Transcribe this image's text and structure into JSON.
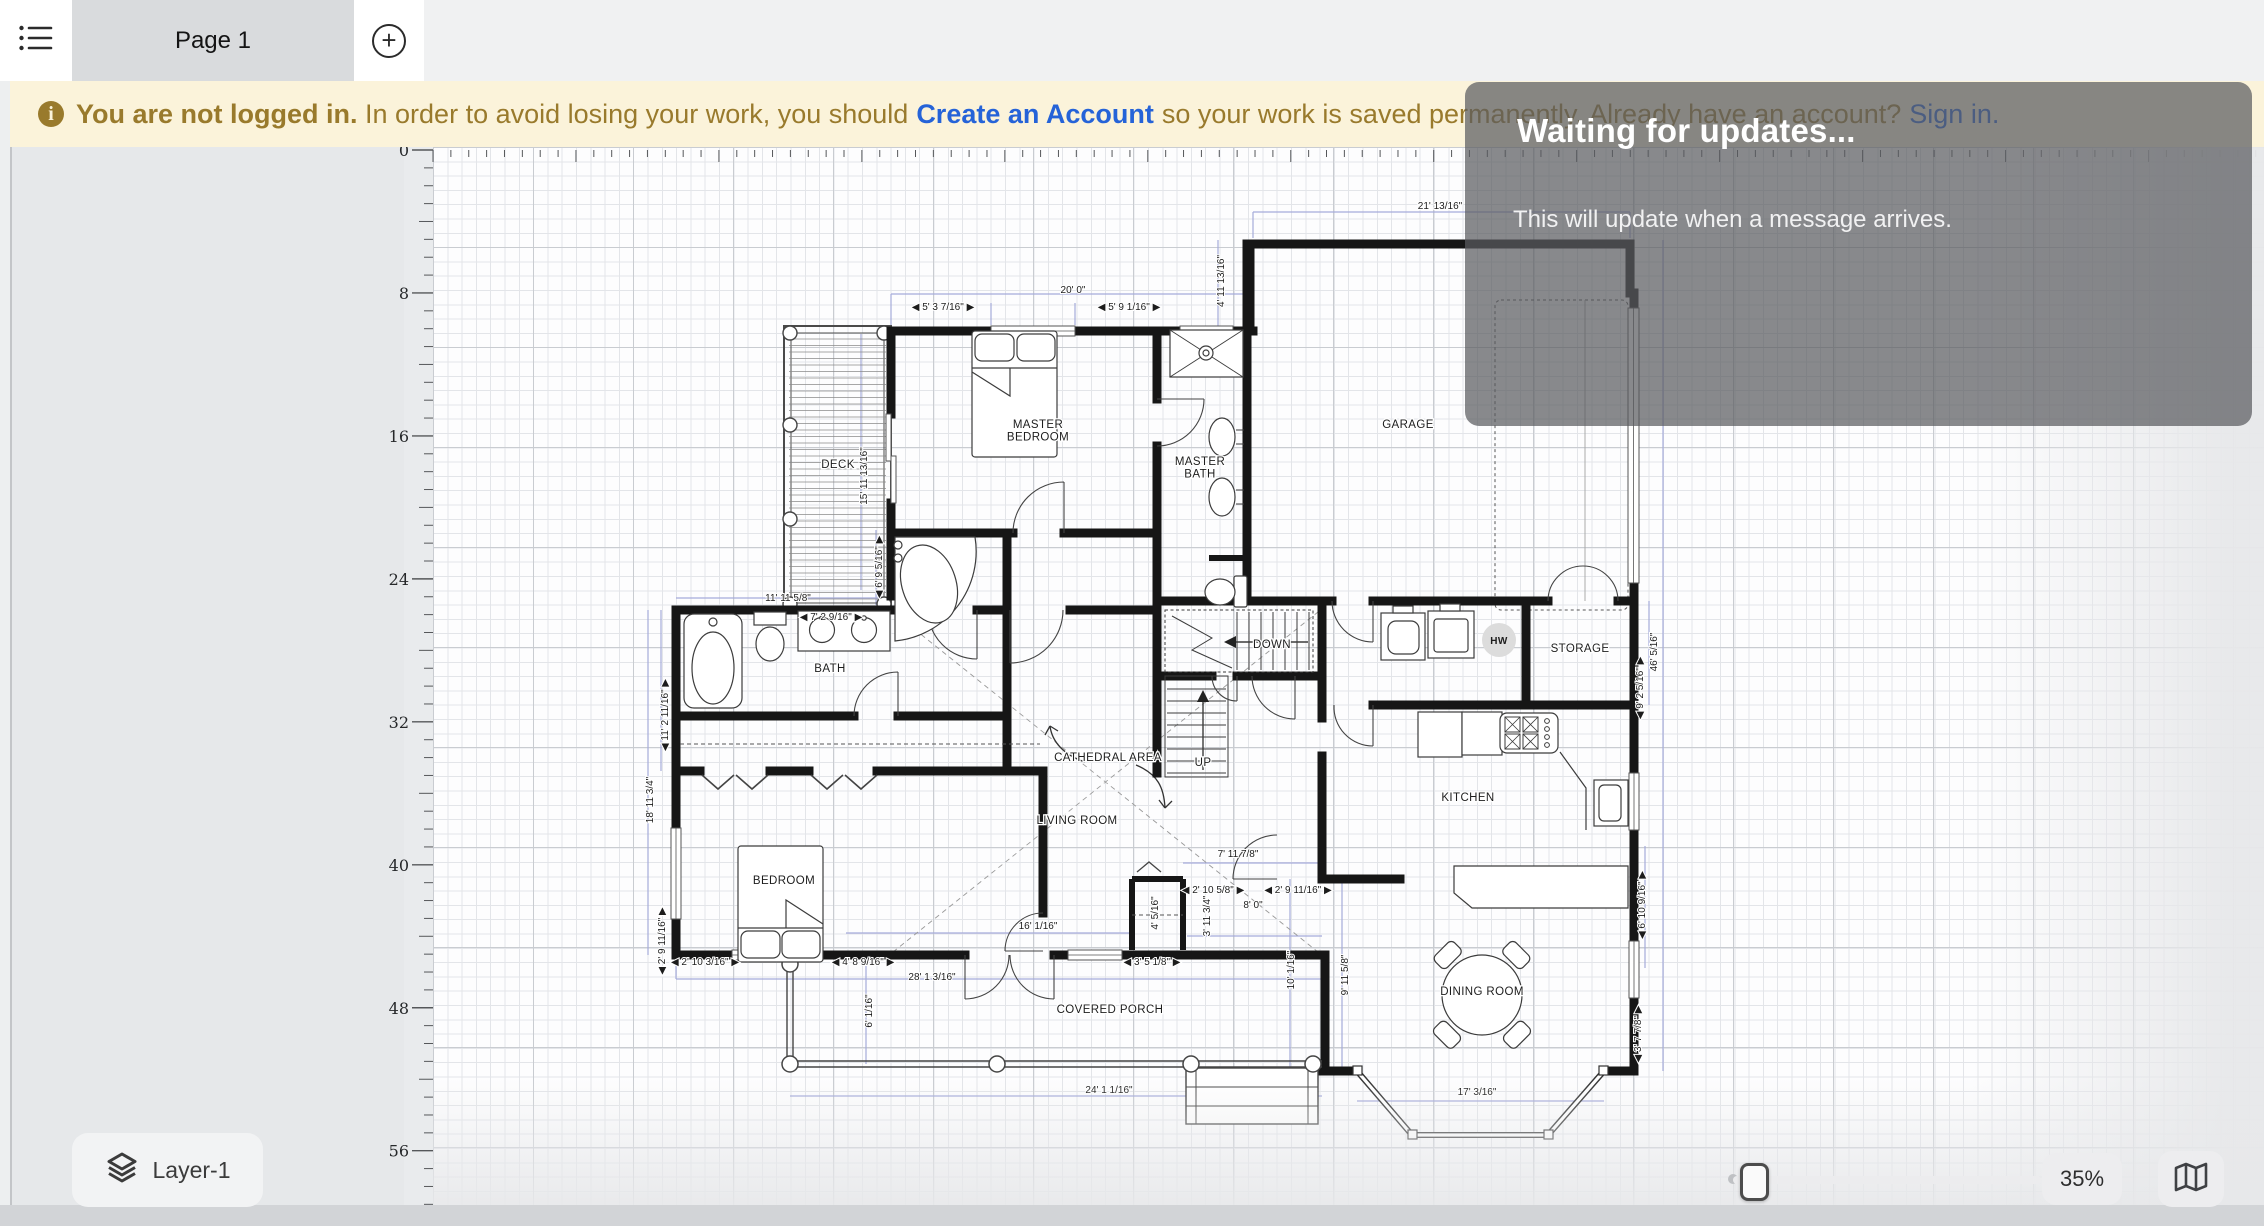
{
  "top_bar": {
    "menu_icon": "list-menu",
    "tab_label": "Page 1",
    "add_page_icon": "plus"
  },
  "banner": {
    "info_icon": "i",
    "bold_text": "You are not logged in.",
    "text_1": "In order to avoid losing your work, you should",
    "link_create": "Create an Account",
    "text_2": "so your work is saved permanently. Already have an account?",
    "link_signin": "Sign in.",
    "bg_color": "#fbf3da",
    "text_color": "#997a2c",
    "link_color": "#2563d8"
  },
  "overlay": {
    "title": "Waiting for updates...",
    "message": "This will update when a message arrives."
  },
  "ruler": {
    "labels": [
      "0",
      "8",
      "16",
      "24",
      "32",
      "40",
      "48",
      "56"
    ],
    "feet_per_label": 8,
    "px_per_foot": 17.87,
    "origin_x": 433,
    "origin_y": 150
  },
  "plan": {
    "rooms": [
      {
        "label": "DECK",
        "x": 838,
        "y": 468
      },
      {
        "lines": [
          "MASTER",
          "BEDROOM"
        ],
        "label": "MASTER BEDROOM",
        "x": 1038,
        "y": 428
      },
      {
        "lines": [
          "MASTER",
          "BATH"
        ],
        "label": "MASTER BATH",
        "x": 1200,
        "y": 465
      },
      {
        "label": "GARAGE",
        "x": 1408,
        "y": 428
      },
      {
        "label": "BATH",
        "x": 830,
        "y": 672
      },
      {
        "label": "DOWN",
        "x": 1272,
        "y": 648
      },
      {
        "label": "UP",
        "x": 1203,
        "y": 766
      },
      {
        "label": "HW",
        "x": 1499,
        "y": 644,
        "style": "hw"
      },
      {
        "label": "STORAGE",
        "x": 1580,
        "y": 652
      },
      {
        "label": "CATHEDRAL AREA",
        "x": 1108,
        "y": 761
      },
      {
        "label": "LIVING ROOM",
        "x": 1077,
        "y": 824
      },
      {
        "label": "KITCHEN",
        "x": 1468,
        "y": 801
      },
      {
        "label": "BEDROOM",
        "x": 784,
        "y": 884
      },
      {
        "label": "DINING ROOM",
        "x": 1482,
        "y": 995
      },
      {
        "label": "COVERED PORCH",
        "x": 1110,
        "y": 1013
      }
    ],
    "dimensions": [
      {
        "t": "21' 13/16\"",
        "x": 1440,
        "y": 209,
        "r": 0
      },
      {
        "t": "20' 0\"",
        "x": 1073,
        "y": 293,
        "r": 0
      },
      {
        "t": "◀ 5' 3 7/16\" ▶",
        "x": 943,
        "y": 310,
        "r": 0
      },
      {
        "t": "◀ 5' 9 1/16\" ▶",
        "x": 1129,
        "y": 310,
        "r": 0
      },
      {
        "t": "4' 11 13/16\"",
        "x": 1224,
        "y": 281,
        "r": -90
      },
      {
        "t": "15' 11 13/16\"",
        "x": 867,
        "y": 476,
        "r": -90
      },
      {
        "t": "◀ 6' 9 5/16\" ▶",
        "x": 882,
        "y": 567,
        "r": -90
      },
      {
        "t": "11' 11 5/8\"",
        "x": 788,
        "y": 601,
        "r": 0
      },
      {
        "t": "◀ 7' 2 9/16\" ▶",
        "x": 831,
        "y": 620,
        "r": 0
      },
      {
        "t": "◀ 11' 2 11/16\" ▶",
        "x": 668,
        "y": 715,
        "r": -90
      },
      {
        "t": "18' 11 3/4\"",
        "x": 653,
        "y": 800,
        "r": -90
      },
      {
        "t": "◀ 2' 9 11/16\" ▶",
        "x": 665,
        "y": 941,
        "r": -90
      },
      {
        "t": "◀ 2' 10 3/16\" ▶",
        "x": 705,
        "y": 965,
        "r": 0
      },
      {
        "t": "◀ 4' 8 9/16\" ▶",
        "x": 863,
        "y": 965,
        "r": 0
      },
      {
        "t": "28' 1 3/16\"",
        "x": 932,
        "y": 980,
        "r": 0
      },
      {
        "t": "6' 1/16\"",
        "x": 872,
        "y": 1011,
        "r": -90
      },
      {
        "t": "16' 1/16\"",
        "x": 1038,
        "y": 929,
        "r": 0
      },
      {
        "t": "24' 1 1/16\"",
        "x": 1109,
        "y": 1093,
        "r": 0
      },
      {
        "t": "◀ 3' 5 1/8\" ▶",
        "x": 1152,
        "y": 965,
        "r": 0
      },
      {
        "t": "7' 11 7/8\"",
        "x": 1238,
        "y": 857,
        "r": 0
      },
      {
        "t": "◀ 2' 10 5/8\" ▶",
        "x": 1213,
        "y": 893,
        "r": 0
      },
      {
        "t": "◀ 2' 9 11/16\" ▶",
        "x": 1298,
        "y": 893,
        "r": 0
      },
      {
        "t": "8' 0\"",
        "x": 1253,
        "y": 908,
        "r": 0
      },
      {
        "t": "3' 11 3/4\"",
        "x": 1210,
        "y": 916,
        "r": -90
      },
      {
        "t": "4' 5/16\"",
        "x": 1158,
        "y": 913,
        "r": -90
      },
      {
        "t": "10' 1/16\"",
        "x": 1294,
        "y": 970,
        "r": -90
      },
      {
        "t": "9' 11 5/8\"",
        "x": 1348,
        "y": 975,
        "r": -90
      },
      {
        "t": "17' 3/16\"",
        "x": 1477,
        "y": 1095,
        "r": 0
      },
      {
        "t": "◀ 3' 7 7/8\" ▶",
        "x": 1641,
        "y": 1034,
        "r": -90
      },
      {
        "t": "◀ 6' 10 9/16\" ▶",
        "x": 1645,
        "y": 905,
        "r": -90
      },
      {
        "t": "◀ 9' 2 5/16\" ▶",
        "x": 1643,
        "y": 688,
        "r": -90
      },
      {
        "t": "46' 5/16\"",
        "x": 1657,
        "y": 652,
        "r": -90
      }
    ]
  },
  "controls": {
    "layer_button_label": "Layer-1",
    "layers_icon": "layers",
    "zoom_percent": "35%",
    "map_icon": "map",
    "accent_button_bg": "#ededef"
  }
}
